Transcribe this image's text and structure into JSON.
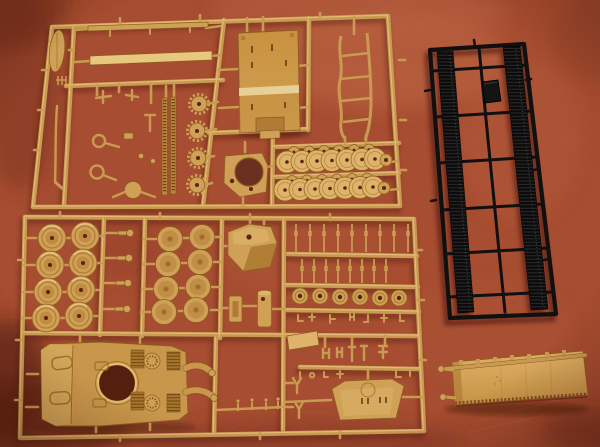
{
  "scene": {
    "type": "photograph",
    "subject": "Plastic scale-model tank kit sprues laid out on a mottled rust-red leather surface",
    "photo_alt": "Photo of model kit contents: two large sand-tan injection-molded sprues holding tank hull, turret, road wheels, sprockets and detail parts; one black sprue carrying two long lengths of tank track; and a loose sand-tan lower hull tub at bottom right, all on a mottled terracotta background"
  },
  "colors": {
    "bg_base": "#a74d31",
    "bg_light": "#c06a46",
    "bg_mid": "#b35c3c",
    "bg_dark": "#7c3322",
    "bg_deep": "#5f2415",
    "tan": "#c99a52",
    "tan_light": "#e8c77e",
    "tan_dark": "#8a6120",
    "tan_part": "#d0a057",
    "tan_part_light": "#dfb46a",
    "tan_deep": "#b07c35",
    "hull_tan": "#c9974b",
    "hole_dark": "#5c240f",
    "black_plastic": "#101010",
    "black_hi": "#383838",
    "shadow": "#4f1c0c"
  },
  "objects": {
    "sprue_tan_top": {
      "label": "tan detail sprue A",
      "material": "sand-tan styrene",
      "parts": [
        "fender strips",
        "oval plate",
        "long rod",
        "suspension brackets",
        "track sections",
        "drive sprockets",
        "engine deck panel",
        "gun mount ring plate",
        "overlapped road wheel rows",
        "cleaning rod frame"
      ]
    },
    "sprue_tan_bottom": {
      "label": "tan detail sprue B",
      "material": "sand-tan styrene",
      "parts": [
        "large road wheels",
        "axle pins",
        "inner wheels",
        "turret shell",
        "fuel drum",
        "frame ring",
        "torsion bars",
        "small wheels",
        "flat plate",
        "rear hull plate",
        "upper hull with turret ring"
      ]
    },
    "sprue_black": {
      "label": "black track sprue",
      "material": "black styrene",
      "parts": [
        "left track run",
        "right track run",
        "tow block"
      ]
    },
    "hull_tub": {
      "label": "loose lower hull tub",
      "material": "sand-tan styrene"
    }
  },
  "counts": {
    "large_road_wheels": 8,
    "inner_wheels": 8,
    "overlap_wheel_rows": 2,
    "overlap_wheels_per_row": 7,
    "drive_sprockets": 4,
    "small_wheels": 6,
    "axle_pins": 4,
    "torsion_bars": 17,
    "track_runs": 2,
    "engine_fan_covers": 2,
    "engine_grilles": 4
  }
}
